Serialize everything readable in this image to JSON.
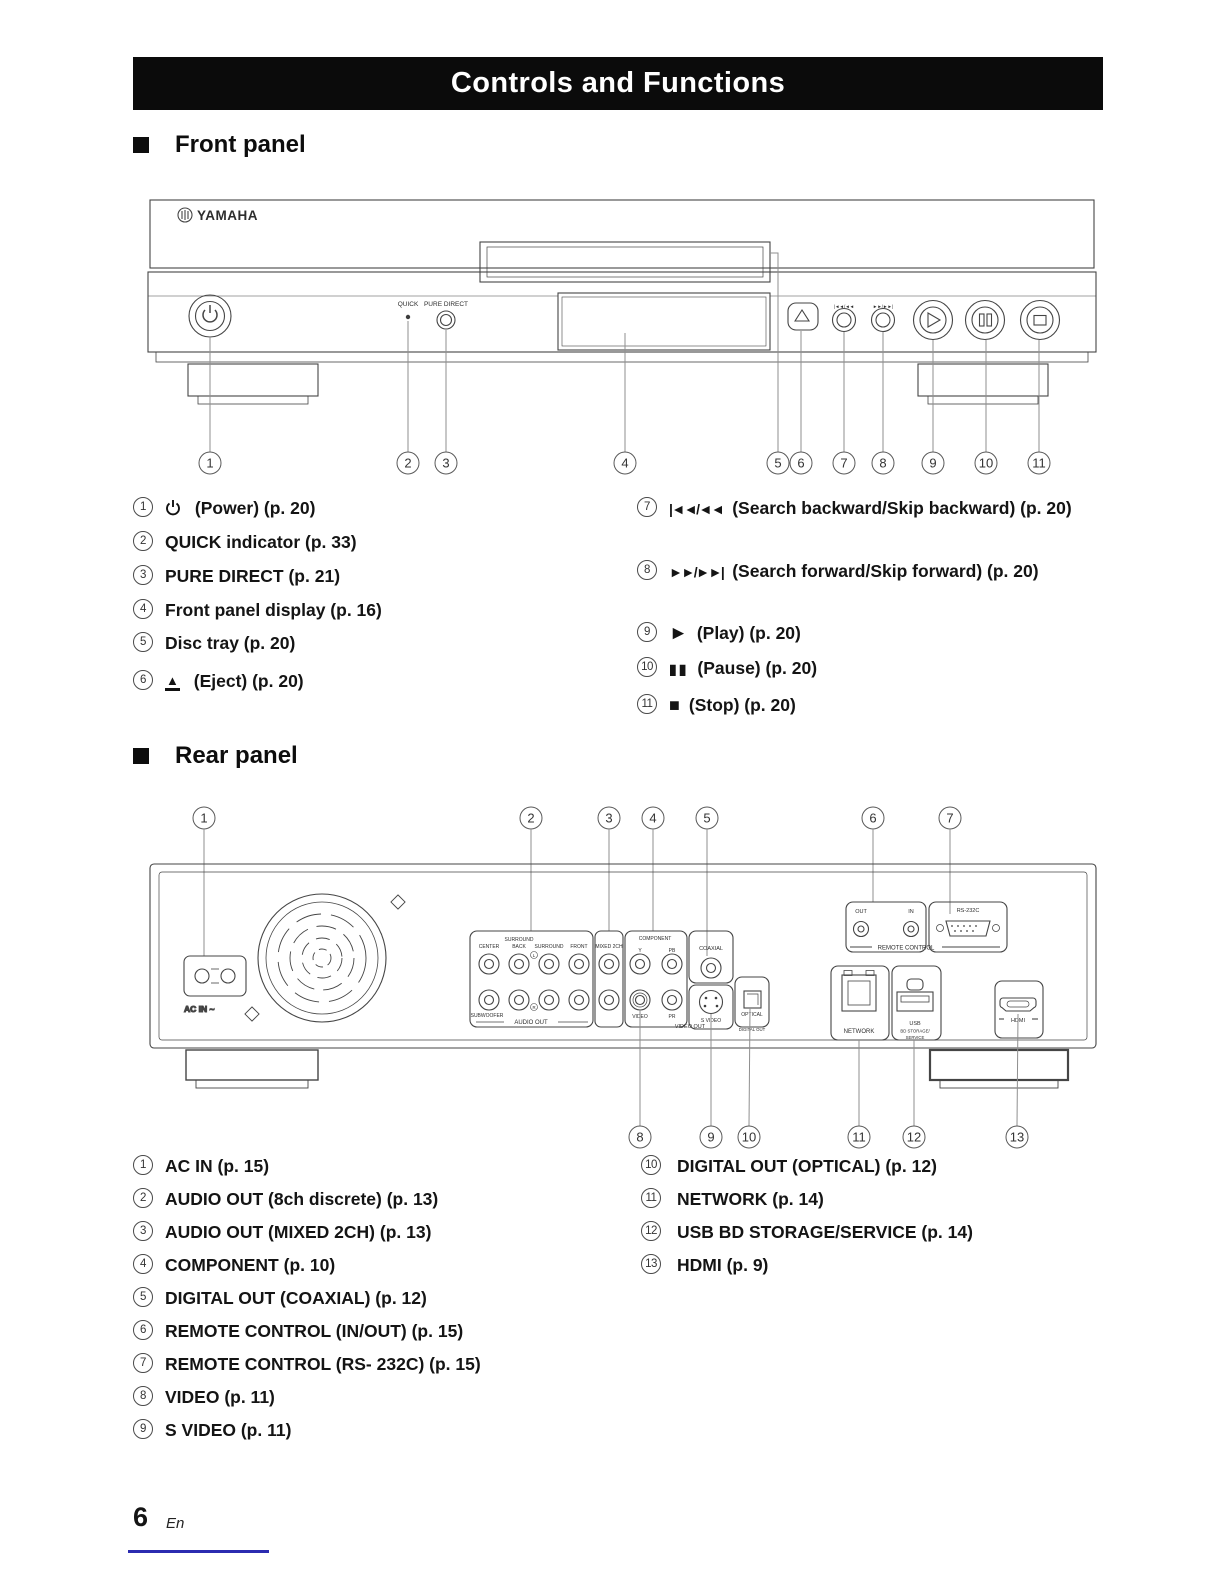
{
  "page": {
    "title": "Controls and Functions",
    "footer_page_number": "6",
    "footer_language": "En"
  },
  "sections": {
    "front": "Front panel",
    "rear": "Rear panel"
  },
  "front_diagram": {
    "brand": "YAMAHA",
    "labels": {
      "quick": "QUICK",
      "pure_direct": "PURE DIRECT",
      "search_back": "|◄◄/◄◄",
      "search_fwd": "►►/►►|"
    },
    "callouts": [
      "1",
      "2",
      "3",
      "4",
      "5",
      "6",
      "7",
      "8",
      "9",
      "10",
      "11"
    ]
  },
  "rear_diagram": {
    "callouts_top": [
      "1",
      "2",
      "3",
      "4",
      "5",
      "6",
      "7"
    ],
    "callouts_bottom": [
      "8",
      "9",
      "10",
      "11",
      "12",
      "13"
    ],
    "labels": {
      "ac_in": "AC IN ~",
      "center": "CENTER",
      "surround": "SURROUND",
      "back": "BACK",
      "surround2": "SURROUND",
      "front": "FRONT",
      "subwoofer": "SUBWOOFER",
      "l": "L",
      "r": "R",
      "audio_out": "AUDIO OUT",
      "mixed_2ch": "MIXED 2CH",
      "component": "COMPONENT",
      "y": "Y",
      "pb": "PB",
      "pr": "PR",
      "video": "VIDEO",
      "video_out": "VIDEO OUT",
      "coaxial": "COAXIAL",
      "s_video": "S VIDEO",
      "optical": "OPTICAL",
      "digital_out": "DIGITAL OUT",
      "out": "OUT",
      "in": "IN",
      "rs232c": "RS-232C",
      "remote_control": "REMOTE CONTROL",
      "network": "NETWORK",
      "usb": "USB",
      "bd_storage": "BD STORAGE/",
      "service": "SERVICE",
      "hdmi": "HDMI"
    }
  },
  "front_list": {
    "left": [
      {
        "num": "1",
        "text": "(Power) (p. 20)"
      },
      {
        "num": "2",
        "text": "QUICK indicator (p. 33)"
      },
      {
        "num": "3",
        "text": "PURE DIRECT (p. 21)"
      },
      {
        "num": "4",
        "text": "Front panel display (p. 16)"
      },
      {
        "num": "5",
        "text": "Disc tray (p. 20)"
      },
      {
        "num": "6",
        "glyph": "▲",
        "text": "(Eject) (p. 20)"
      }
    ],
    "right": [
      {
        "num": "7",
        "glyph": "|◄◄/◄◄",
        "text": "(Search backward/Skip backward) (p. 20)"
      },
      {
        "num": "8",
        "glyph": "►►/►►|",
        "text": "(Search forward/Skip forward) (p. 20)"
      },
      {
        "num": "9",
        "glyph": "►",
        "text": "(Play) (p. 20)"
      },
      {
        "num": "10",
        "glyph": "▮▮",
        "text": "(Pause) (p. 20)"
      },
      {
        "num": "11",
        "glyph": "■",
        "text": "(Stop) (p. 20)"
      }
    ]
  },
  "rear_list": {
    "left": [
      {
        "num": "1",
        "text": "AC IN (p. 15)"
      },
      {
        "num": "2",
        "text": "AUDIO OUT (8ch discrete) (p. 13)"
      },
      {
        "num": "3",
        "text": "AUDIO OUT (MIXED 2CH) (p. 13)"
      },
      {
        "num": "4",
        "text": "COMPONENT (p. 10)"
      },
      {
        "num": "5",
        "text": "DIGITAL OUT (COAXIAL) (p. 12)"
      },
      {
        "num": "6",
        "text": "REMOTE CONTROL (IN/OUT) (p. 15)"
      },
      {
        "num": "7",
        "text": "REMOTE CONTROL (RS- 232C) (p. 15)"
      },
      {
        "num": "8",
        "text": "VIDEO (p. 11)"
      },
      {
        "num": "9",
        "text": "S VIDEO (p. 11)"
      }
    ],
    "right": [
      {
        "num": "10",
        "text": "DIGITAL OUT (OPTICAL) (p. 12)"
      },
      {
        "num": "11",
        "text": "NETWORK (p. 14)"
      },
      {
        "num": "12",
        "text": "USB BD STORAGE/SERVICE (p. 14)"
      },
      {
        "num": "13",
        "text": "HDMI (p. 9)"
      }
    ]
  }
}
